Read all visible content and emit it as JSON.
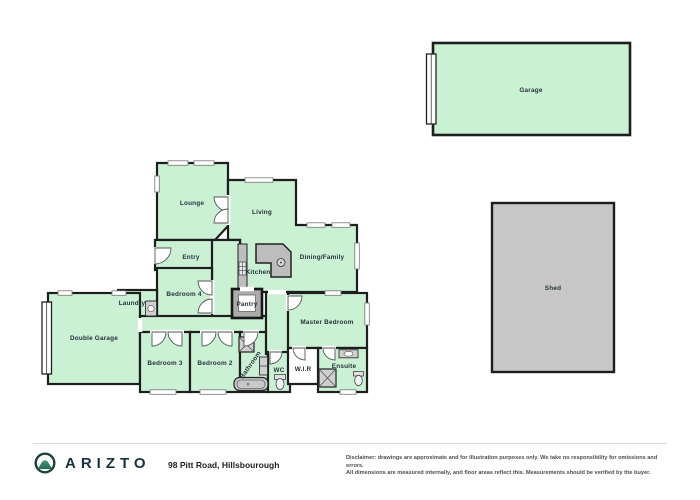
{
  "plan": {
    "rooms": {
      "lounge": {
        "label": "Lounge"
      },
      "living": {
        "label": "Living"
      },
      "entry": {
        "label": "Entry"
      },
      "kitchen": {
        "label": "Kitchen"
      },
      "dining": {
        "label": "Dining/Family"
      },
      "bedroom4": {
        "label": "Bedroom 4"
      },
      "laundry": {
        "label": "Laundry"
      },
      "pantry": {
        "label": "Pantry"
      },
      "double_garage": {
        "label": "Double Garage"
      },
      "bedroom3": {
        "label": "Bedroom 3"
      },
      "bedroom2": {
        "label": "Bedroom 2"
      },
      "bathroom": {
        "label": "Bathroom"
      },
      "wc": {
        "label": "WC"
      },
      "wir": {
        "label": "W.I.R"
      },
      "master": {
        "label": "Master Bedroom"
      },
      "ensuite": {
        "label": "Ensuite"
      },
      "garage": {
        "label": "Garage"
      },
      "shed": {
        "label": "Shed"
      }
    },
    "colors": {
      "room_fill": "#cbf1d5",
      "wall": "#1e1e1e",
      "fixture_fill": "#bdbdbd",
      "shed_fill": "#c7c7c7",
      "brand_teal": "#1d403c",
      "brand_green": "#3c8a62"
    }
  },
  "footer": {
    "brand": "ARIZTO",
    "address": "98 Pitt Road, Hillsbourough",
    "disclaimer_line1": "Disclaimer: drawings are approximate and for illustration purposes only. We take no responsibility for omissions and errors.",
    "disclaimer_line2": "All dimensions are measured internally, and floor areas reflect this. Measurements should be verified by the buyer."
  }
}
